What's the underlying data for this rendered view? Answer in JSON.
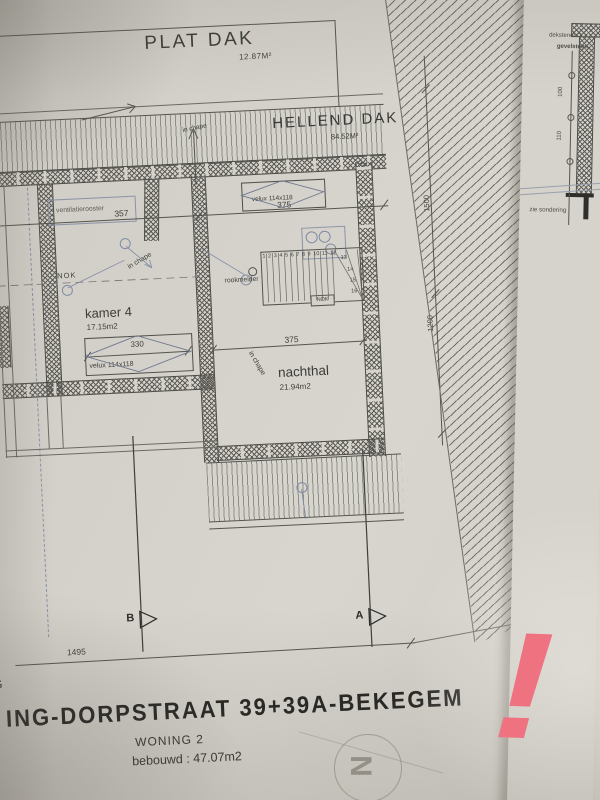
{
  "colors": {
    "paper": "#d4d1ca",
    "ink": "#4a4a46",
    "blue_symbol": "#7f8aa3",
    "red_mark": "#ef7280"
  },
  "roof": {
    "plat_dak_label": "PLAT DAK",
    "plat_dak_area": "12.87M²",
    "hellend_dak_label": "HELLEND DAK",
    "hellend_dak_area": "84.52M²"
  },
  "rooms": {
    "kamer4_label": "kamer 4",
    "kamer4_area": "17.15m2",
    "nachthal_label": "nachthal",
    "nachthal_area": "21.94m2"
  },
  "annotations": {
    "in_chape_top": "in chape",
    "in_chape_left": "in chape",
    "in_chape_nachthal": "in chape",
    "nok_left": "NOK",
    "nok_stairs": "NOK",
    "rookmelder": "rookmelder",
    "ventilatierooster": "ventilatierooster",
    "velux_top": "velux 114x118",
    "velux_kamer4": "velux 114x118"
  },
  "dimensions": {
    "d357": "357",
    "d375_top": "375",
    "d375_mid": "375",
    "d330": "330",
    "d1495": "1495",
    "d1500": "1500",
    "d1200": "1200"
  },
  "stairs": {
    "treads": [
      "1",
      "2",
      "3",
      "4",
      "5",
      "6",
      "7",
      "8",
      "9",
      "10",
      "11",
      "12"
    ],
    "winders": [
      "13",
      "14",
      "15",
      "16"
    ]
  },
  "sections": {
    "marker_a": "A",
    "marker_b": "B",
    "arrow_glyph": "▷"
  },
  "title_block": {
    "partial_left": "G",
    "street_line": "ING-DORPSTRAAT 39+39A-BEKEGEM",
    "woning": "WONING 2",
    "bebouwd": "bebouwd : 47.07m2"
  },
  "detail_sheet": {
    "dekstenen": "dekstenen 3",
    "gevelsteen": "gevelsteen",
    "d100": "100",
    "d110": "110",
    "zie_sondering": "zie sondering"
  },
  "compass": {
    "north": "N"
  },
  "watermark": {
    "exclamation": "!"
  }
}
